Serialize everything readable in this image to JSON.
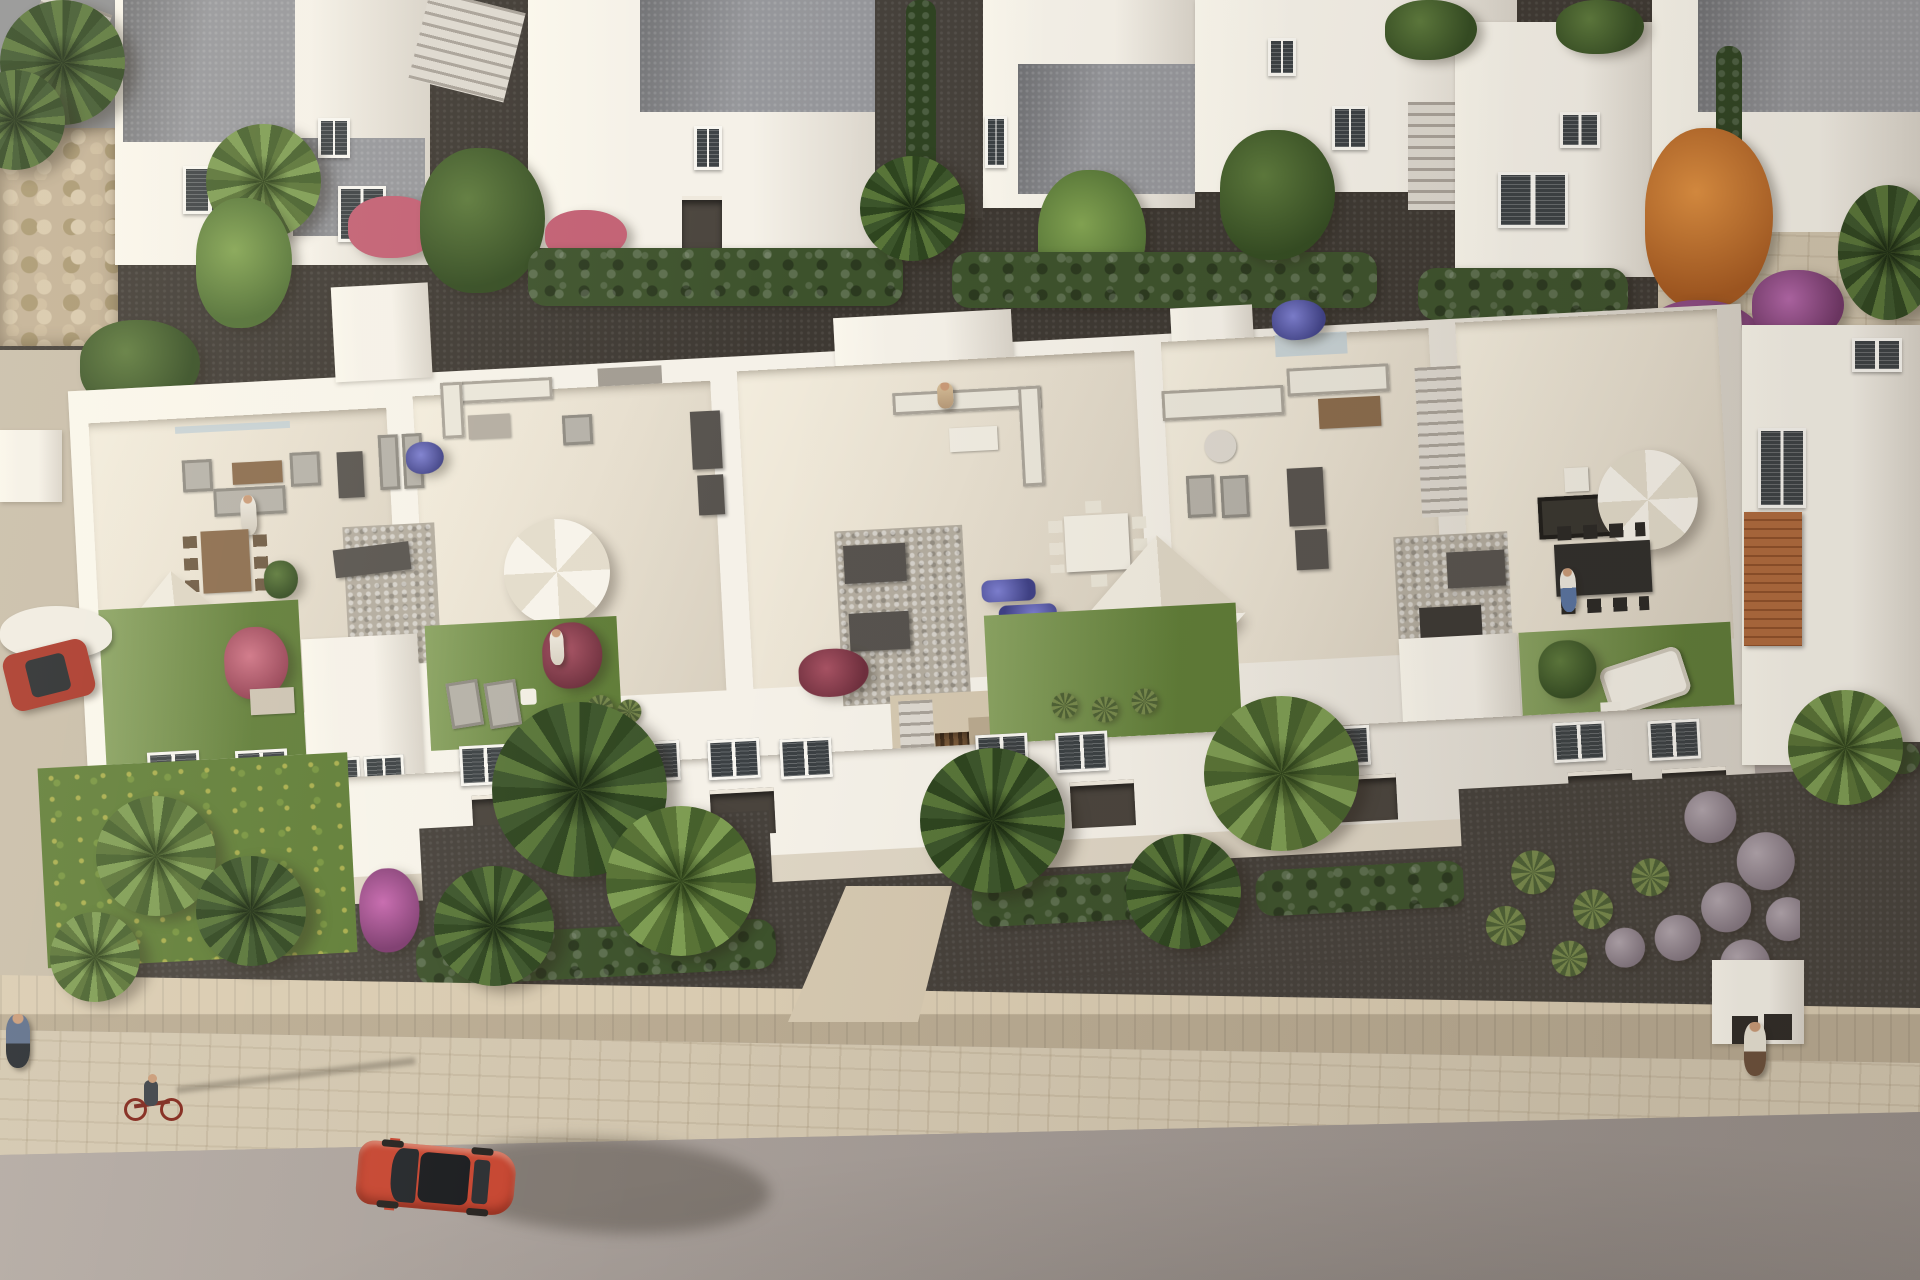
{
  "scene": {
    "type": "aerial-3d-architectural-render",
    "setting": "Row of five modern white townhouses with rooftop solarium terraces, rear service houses, front gardens, a stone boundary wall, sidewalk and asphalt street in warm low sunlight",
    "landmarks": {
      "rooftop_terraces": 5,
      "vehicles": [
        "red car driving on the street",
        "dark red car parked at the left driveway"
      ],
      "people": [
        "pedestrian on left sidewalk",
        "cyclist riding a red bicycle on the sidewalk",
        "pedestrian walking on right sidewalk",
        "person standing on terrace 1",
        "person on terrace 2 lawn",
        "person seated on terrace 3 sofa",
        "person at terrace 5 dining table"
      ],
      "vegetation": [
        "fan palms",
        "banana plants",
        "cypress hedges",
        "orange autumn tree",
        "purple bougainvillea",
        "pink flowering shrubs",
        "lavender ball shrubs",
        "yellow flower meadow",
        "rooftop lawns"
      ],
      "furniture": [
        "white square parasols",
        "white round parasols",
        "gray lounge sofas",
        "white cushion sofas",
        "wooden dining set",
        "white dining set",
        "black dining set",
        "sun loungers",
        "storage boxes",
        "gravel courts"
      ],
      "structures": [
        "external staircases",
        "stone boundary wall",
        "pebble retaining wall",
        "entrance corridor with wooden slat door",
        "right entrance portal",
        "terracotta tiled roof strip"
      ]
    }
  },
  "palette": {
    "building_white": "#f5f1e8",
    "building_shade": "#e2dccf",
    "roof_gravel": "#95969a",
    "terrace_floor": "#e7dfcf",
    "lawn_green": "#6d8c41",
    "meadow_green": "#5f7d36",
    "hedge_green": "#3d522c",
    "tree_green": "#48632f",
    "palm_light": "#6f8d49",
    "banana_green": "#5e7f3c",
    "orange_tree": "#c67430",
    "bougainvillea_purple": "#a14e97",
    "bougainvillea_pink": "#b0549a",
    "pink_flower": "#c25f73",
    "red_shrub": "#8e4050",
    "blue_flower": "#5a5cb0",
    "dark_path": "#3e3933",
    "dark_soil": "#46413b",
    "light_gravel": "#b3ac9f",
    "dark_box": "#57534e",
    "wood_brown": "#8a6b4c",
    "stone_wall": "#d9cbb1",
    "sidewalk": "#d2c6af",
    "road": "#a89f9a",
    "car_red": "#c64530",
    "car_red_dark": "#a93527",
    "glass_dark": "#3b4043",
    "sofa_gray": "#b5b1a8",
    "furniture_white": "#eae6da",
    "umbrella_white": "#f5f1e8",
    "lavender_bush": "#998c94",
    "terracotta": "#aa6238",
    "walkway": "#d5c8b0",
    "wood_floor": "#b9a98f"
  }
}
